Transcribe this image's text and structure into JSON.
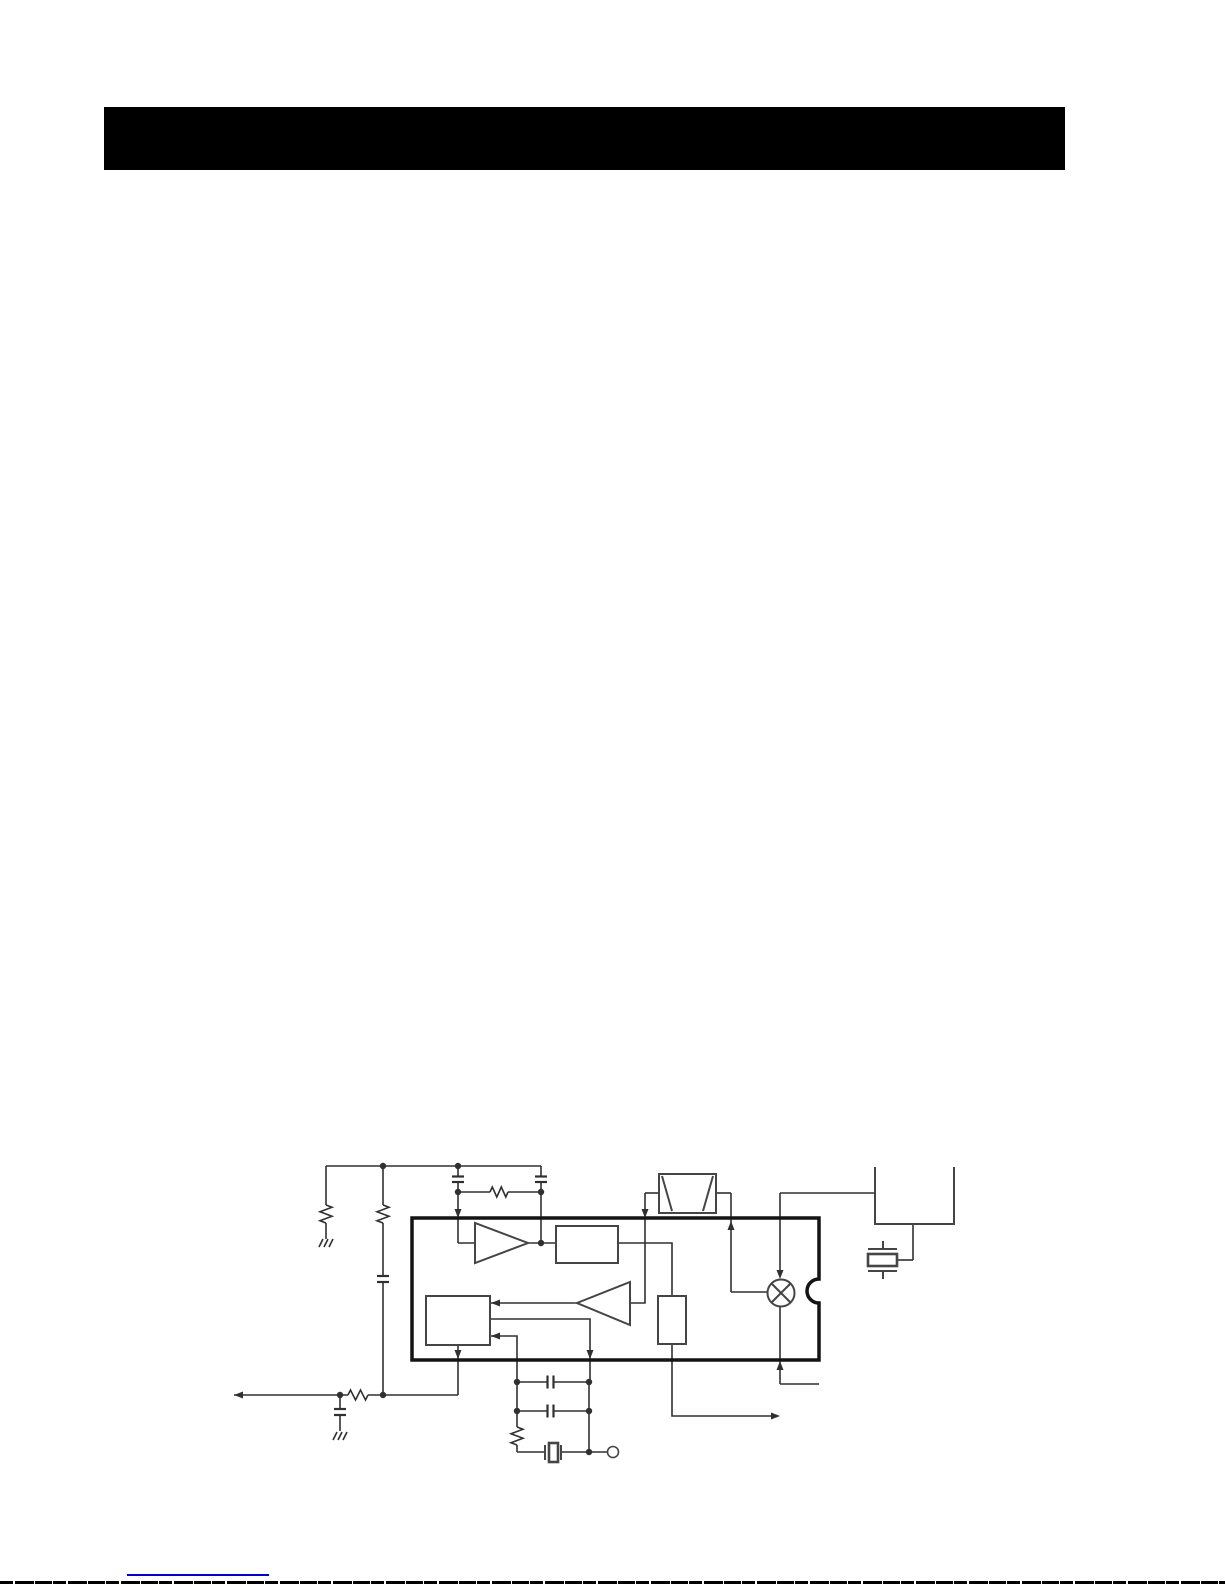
{
  "page": {
    "background_color": "#ffffff"
  },
  "header": {
    "bar_color": "#000000"
  },
  "schematic": {
    "wire_color": "#303030",
    "outline_color": "#454545",
    "ic_border_color": "#141414",
    "symbol_counts": {
      "resistors": 5,
      "capacitors": 6,
      "amplifier_triangles": 2,
      "function_blocks": 3,
      "mixer_circles": 1,
      "filter_boxes": 1,
      "crystal_resonators": 2,
      "ground_symbols": 2,
      "junction_dots": 12,
      "open_terminals": 1,
      "arrowheads": 11
    }
  },
  "footer": {
    "link_line_color": "#0000cc",
    "page_edge_color": "#000000"
  }
}
